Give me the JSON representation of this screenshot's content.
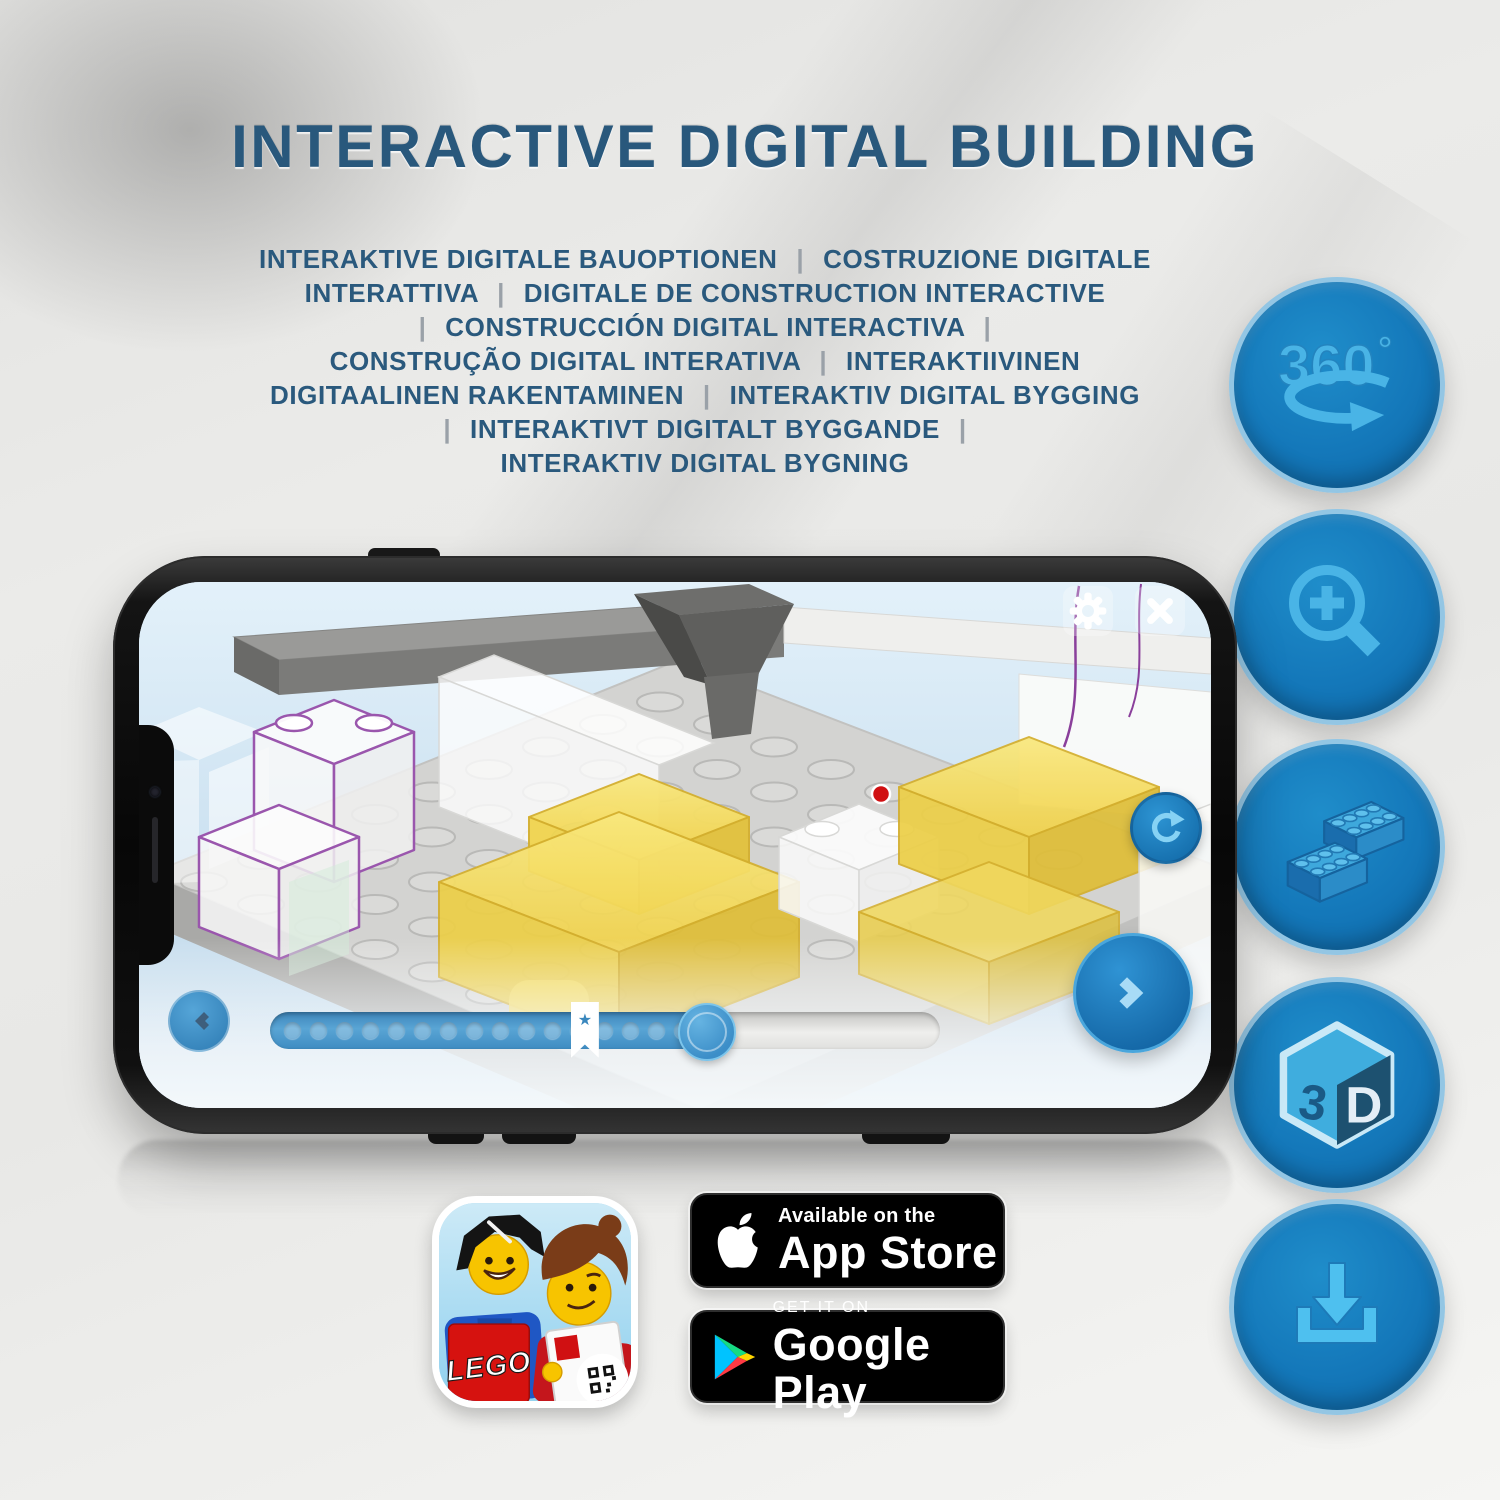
{
  "page": {
    "background_color": "#e8e8e6",
    "accent_blue": "#1176bb",
    "glyph_blue": "#49b4e6",
    "title_color": "#29587c",
    "highlight_yellow": "#f2d654"
  },
  "header": {
    "title": "INTERACTIVE DIGITAL BUILDING"
  },
  "subtitle": {
    "separator": "|",
    "lines": [
      "INTERAKTIVE DIGITALE BAUOPTIONEN | COSTRUZIONE DIGITALE",
      "INTERATTIVA | DIGITALE DE CONSTRUCTION INTERACTIVE",
      "| CONSTRUCCIÓN DIGITAL INTERACTIVA |",
      "CONSTRUÇÃO DIGITAL INTERATIVA | INTERAKTIIVINEN",
      "DIGITAALINEN RAKENTAMINEN | INTERAKTIV DIGITAL BYGGING",
      "| INTERAKTIVT DIGITALT BYGGANDE |",
      "INTERAKTIV DIGITAL BYGNING"
    ]
  },
  "feature_icons": [
    {
      "id": "360-rotation",
      "label": "360",
      "degree": "°"
    },
    {
      "id": "zoom-in"
    },
    {
      "id": "brick-building"
    },
    {
      "id": "3d-view",
      "left_face": "3",
      "right_face": "D"
    },
    {
      "id": "download"
    }
  ],
  "phone_app": {
    "top_right_buttons": [
      "settings",
      "close"
    ],
    "side_button": "rotate-reset",
    "prev_button": "previous-step",
    "next_button": "next-step",
    "slider": {
      "dot_count": 16,
      "progress_percent": 65,
      "bookmark_percent": 47,
      "bookmark_star": "★"
    }
  },
  "store_links": {
    "app_icon_brand": "LEGO",
    "app_store": {
      "line1": "Available on the",
      "line2": "App Store"
    },
    "google_play": {
      "line1": "GET IT ON",
      "line2": "Google Play"
    }
  }
}
